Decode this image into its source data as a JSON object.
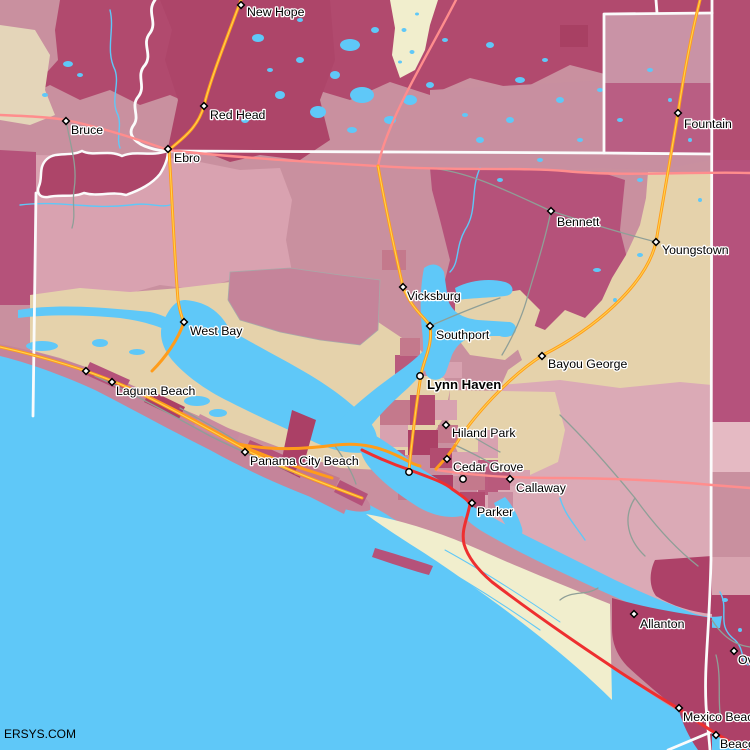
{
  "map": {
    "watermark": "ERSYS.COM",
    "colors": {
      "water": "#5fc8f8",
      "landBase": "#c9909f",
      "dustyPinkNW": "#d9a2b0",
      "dustyPinkSE": "#dbaab6",
      "tan": "#e5d2ab",
      "tanGray": "#e4d5b9",
      "cream": "#f1eecd",
      "darkCrimsonBand": "#b14a6e",
      "darkCrimsonRiver": "#ad4569",
      "crimsonMid": "#b5527a",
      "crimsonSE": "#ad4168",
      "palePink": "#e5bac3",
      "roseMid": "#c5849a",
      "roadOrange": "#ff9c1a",
      "roadOrangeCore": "#ffd24f",
      "roadSalmon": "#ff8d8d",
      "roadRed": "#ee2f30",
      "roadGray": "#8f9f97",
      "boundaryWhite": "#fbfbfb",
      "labelText": "#000000"
    },
    "cities": [
      {
        "name": "New Hope",
        "marker": "diamond",
        "mx": 241,
        "my": 5,
        "lx": 247,
        "ly": 16
      },
      {
        "name": "Red Head",
        "marker": "diamond",
        "mx": 204,
        "my": 106,
        "lx": 210,
        "ly": 119
      },
      {
        "name": "Bruce",
        "marker": "diamond",
        "mx": 66,
        "my": 121,
        "lx": 71,
        "ly": 134
      },
      {
        "name": "Ebro",
        "marker": "diamond",
        "mx": 168,
        "my": 149,
        "lx": 174,
        "ly": 162
      },
      {
        "name": "Fountain",
        "marker": "diamond",
        "mx": 678,
        "my": 113,
        "lx": 684,
        "ly": 128
      },
      {
        "name": "Bennett",
        "marker": "diamond",
        "mx": 551,
        "my": 211,
        "lx": 557,
        "ly": 226
      },
      {
        "name": "Youngstown",
        "marker": "diamond",
        "mx": 656,
        "my": 242,
        "lx": 662,
        "ly": 254
      },
      {
        "name": "Vicksburg",
        "marker": "diamond",
        "mx": 403,
        "my": 287,
        "lx": 407,
        "ly": 300
      },
      {
        "name": "Southport",
        "marker": "diamond",
        "mx": 430,
        "my": 326,
        "lx": 436,
        "ly": 339
      },
      {
        "name": "West Bay",
        "marker": "diamond",
        "mx": 184,
        "my": 322,
        "lx": 190,
        "ly": 335
      },
      {
        "name": "Bayou George",
        "marker": "diamond",
        "mx": 542,
        "my": 356,
        "lx": 548,
        "ly": 368
      },
      {
        "name": "Lynn Haven",
        "marker": "circle",
        "bold": true,
        "mx": 420,
        "my": 376,
        "lx": 427,
        "ly": 389
      },
      {
        "name": "Laguna Beach",
        "marker": "diamond",
        "mx": 112,
        "my": 382,
        "lx": 116,
        "ly": 395
      },
      {
        "name": null,
        "marker": "diamond",
        "mx": 86,
        "my": 371
      },
      {
        "name": "Hiland Park",
        "marker": "diamond",
        "mx": 446,
        "my": 425,
        "lx": 452,
        "ly": 437
      },
      {
        "name": "Panama City Beach",
        "marker": "diamond",
        "mx": 245,
        "my": 452,
        "lx": 250,
        "ly": 465
      },
      {
        "name": "Cedar Grove",
        "marker": "diamond",
        "mx": 447,
        "my": 459,
        "lx": 453,
        "ly": 471
      },
      {
        "name": null,
        "marker": "circle",
        "mx": 409,
        "my": 472
      },
      {
        "name": null,
        "marker": "circle",
        "mx": 463,
        "my": 479
      },
      {
        "name": "Callaway",
        "marker": "diamond",
        "mx": 510,
        "my": 479,
        "lx": 516,
        "ly": 492
      },
      {
        "name": "Parker",
        "marker": "diamond",
        "mx": 472,
        "my": 503,
        "lx": 477,
        "ly": 516
      },
      {
        "name": "Allanton",
        "marker": "diamond",
        "mx": 634,
        "my": 614,
        "lx": 640,
        "ly": 628
      },
      {
        "name": "Mexico Beach",
        "marker": "diamond",
        "mx": 679,
        "my": 708,
        "lx": 683,
        "ly": 721
      },
      {
        "name": "Overstreet",
        "marker": "diamond",
        "mx": 734,
        "my": 651,
        "lx": 738,
        "ly": 664
      },
      {
        "name": "Beacon Hill",
        "marker": "diamond",
        "mx": 716,
        "my": 735,
        "lx": 720,
        "ly": 748
      }
    ]
  }
}
